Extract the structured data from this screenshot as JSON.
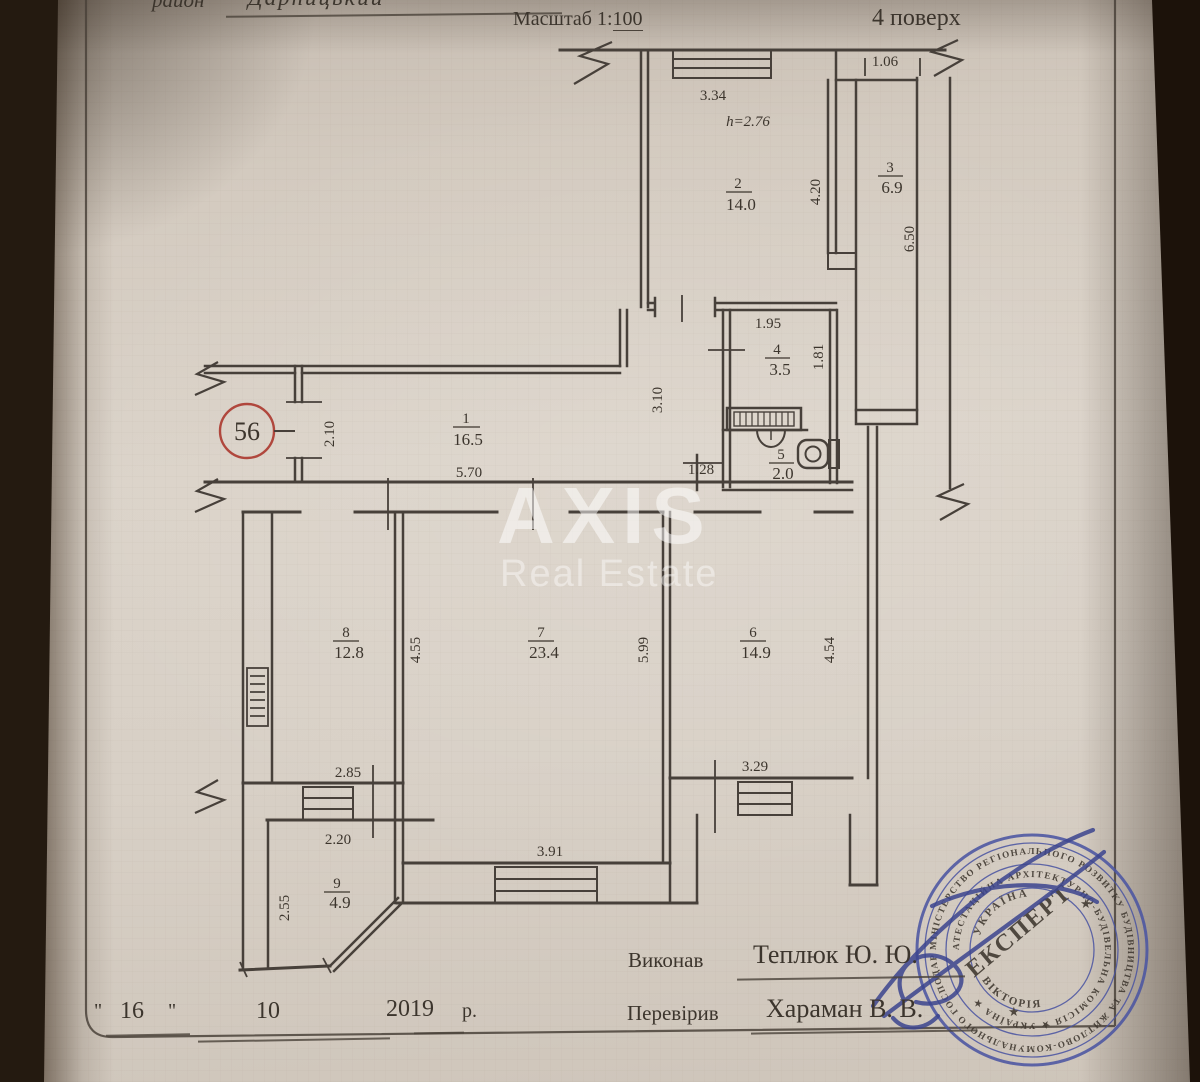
{
  "document": {
    "district_label": "район",
    "district_value": "Дарницький",
    "scale_prefix": "Масштаб 1:",
    "scale_underlined": "100",
    "floor": "4 поверх",
    "executor_label": "Виконав",
    "executor_name": "Теплюк Ю. Ю.",
    "checker_label": "Перевірив",
    "checker_name": "Хараман В. В.",
    "date": {
      "open_quote": "\"",
      "day": "16",
      "close_quote": "\"",
      "month": "10",
      "year": "2019",
      "year_suffix": "р."
    }
  },
  "watermark": {
    "brand": "AXIS",
    "tagline": "Real Estate"
  },
  "apartment": {
    "number": "56"
  },
  "plan": {
    "ceiling_height": "h=2.76",
    "rooms": {
      "r1": {
        "num": "1",
        "area": "16.5"
      },
      "r2": {
        "num": "2",
        "area": "14.0"
      },
      "r3": {
        "num": "3",
        "area": "6.9"
      },
      "r4": {
        "num": "4",
        "area": "3.5"
      },
      "r5": {
        "num": "5",
        "area": "2.0"
      },
      "r6": {
        "num": "6",
        "area": "14.9"
      },
      "r7": {
        "num": "7",
        "area": "23.4"
      },
      "r8": {
        "num": "8",
        "area": "12.8"
      },
      "r9": {
        "num": "9",
        "area": "4.9"
      }
    },
    "dims": {
      "w334": "3.34",
      "d420": "4.20",
      "d106": "1.06",
      "d650": "6.50",
      "d195": "1.95",
      "d181": "1.81",
      "d128": "1.28",
      "d210": "2.10",
      "d570": "5.70",
      "d310": "3.10",
      "d455": "4.55",
      "d599": "5.99",
      "d454": "4.54",
      "d285": "2.85",
      "d220": "2.20",
      "d255": "2.55",
      "d391": "3.91",
      "d329": "3.29"
    }
  },
  "stamp": {
    "ring_outer": "МІНІСТЕРСТВО РЕГІОНАЛЬНОГО РОЗВИТКУ БУДІВНИЦТВА ТА ЖИТЛОВО-КОМУНАЛЬНОГО ГОСПОДАРСТВА УКРАЇНИ",
    "ring_middle": "АТЕСТАЦІЙНА АРХІТЕКТУРНО-БУДІВЕЛЬНА КОМІСІЯ ★ УКРАЇНА ★",
    "center": "ЕКСПЕРТ",
    "arc_top": "УКРАЇНА",
    "arc_bottom": "ВІКТОРІЯ",
    "star_right": "★",
    "star_bottom": "★"
  }
}
